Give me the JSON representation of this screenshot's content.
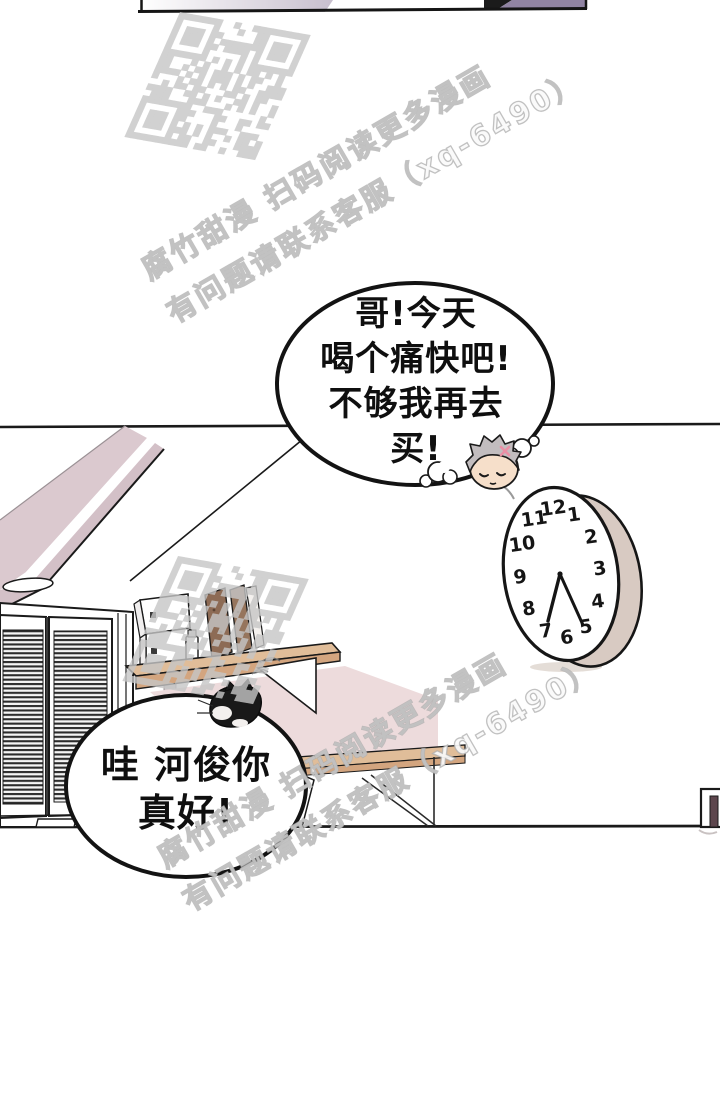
{
  "comic": {
    "bubble1": {
      "line1": "哥!今天",
      "line2": "喝个痛快吧!",
      "line3": "不够我再去",
      "line4": "买!"
    },
    "bubble2": {
      "line1": "哇 河俊你",
      "line2": "真好!"
    }
  },
  "watermark": {
    "line1": "腐竹甜漫 扫码阅读更多漫画",
    "line2": "有问题请联系客服（xq-6490）",
    "color": "#c6c6c6"
  },
  "clock": {
    "numbers": [
      "1",
      "2",
      "3",
      "4",
      "5",
      "6",
      "7",
      "8",
      "9",
      "10",
      "11",
      "12"
    ],
    "approx_time": "6:26"
  },
  "colors": {
    "panel_purple": "#9184a3",
    "panel_gradient_end": "#c8bfce",
    "beam_mauve": "#dbc9cf",
    "beam_mauve_dark": "#d3c0c7",
    "shelf_wood": "#e0bd99",
    "shelf_wood_dark": "#d3a57f",
    "wall_shadow_pink": "#eddbdc",
    "clock_rim": "#d8cac2",
    "door_bar": "#5d464d",
    "cat_black": "#191919",
    "book_brown": "#8d6b55",
    "book_brown2": "#96755d"
  }
}
